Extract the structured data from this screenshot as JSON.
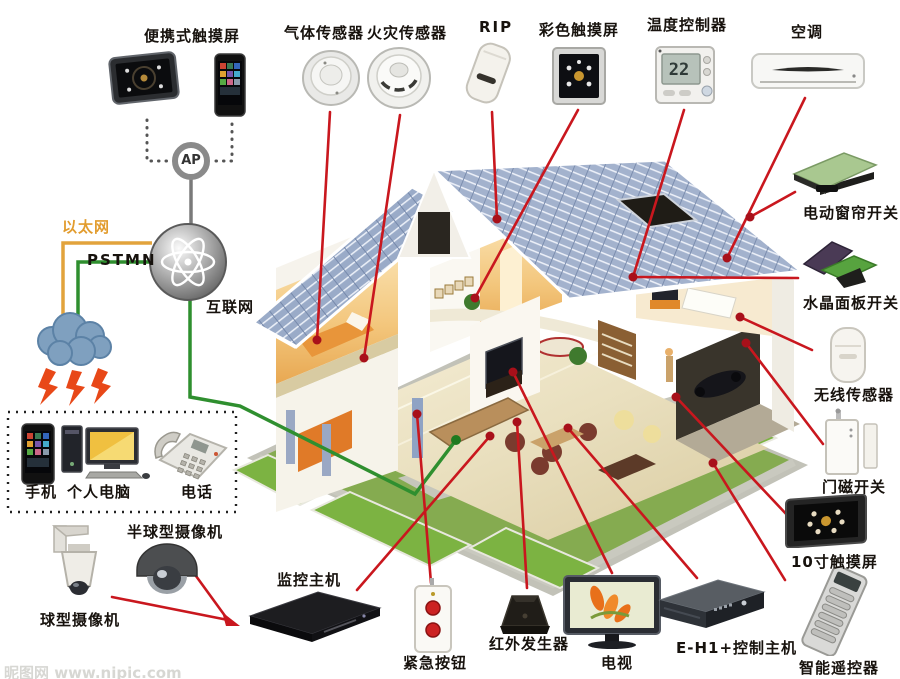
{
  "watermark": "昵图网 www.nipic.com",
  "network": {
    "ap": "AP",
    "ethernet": "以太网",
    "pstmn": "PSTMN",
    "internet": "互联网"
  },
  "thermostat": {
    "value": "22"
  },
  "labels": {
    "portable_touchscreen": "便携式触摸屏",
    "gas_sensor": "气体传感器",
    "fire_sensor": "火灾传感器",
    "rip": "RIP",
    "color_touchscreen": "彩色触摸屏",
    "temp_controller": "温度控制器",
    "air_conditioner": "空调",
    "curtain_switch": "电动窗帘开关",
    "crystal_panel_switch": "水晶面板开关",
    "wireless_sensor": "无线传感器",
    "door_magnet_switch": "门磁开关",
    "touchscreen_10in": "10寸触摸屏",
    "smart_remote": "智能遥控器",
    "ball_camera": "球型摄像机",
    "dome_camera": "半球型摄像机",
    "monitor_host": "监控主机",
    "emergency_button": "紧急按钮",
    "ir_generator": "红外发生器",
    "tv": "电视",
    "eh1_host": "E-H1+控制主机",
    "mobile_phone": "手机",
    "pc": "个人电脑",
    "telephone": "电话"
  },
  "colors": {
    "connector_red": "#c9171e",
    "ethernet_yellow": "#e29c2e",
    "pstn_green": "#2f8f2f",
    "roof_blue": "#9aabc8",
    "lawn_green": "#85ab50"
  }
}
